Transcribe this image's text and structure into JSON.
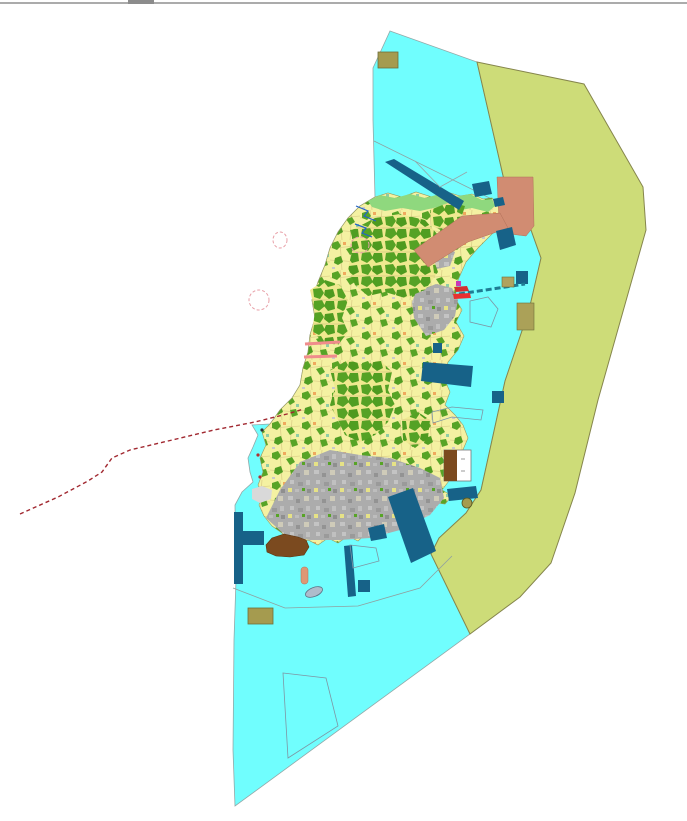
{
  "canvas": {
    "width": 687,
    "height": 821
  },
  "chrome": {
    "top_rule_color": "#ABABAB",
    "top_notch_color": "#8C8C8C",
    "top_notch_x": 128,
    "top_notch_width": 26
  },
  "palette": {
    "water": "#70FEFE",
    "buffer_zone": "#CDDC78",
    "island_parcel_yellow": "#F4F1A2",
    "forest_green": "#55A225",
    "urban_gray": "#ACACAC",
    "navy_structure": "#176288",
    "salmon_district": "#D18C72",
    "brown_port": "#7B4A1F",
    "khaki_block": "#A59B4F",
    "coast_green": "#8FD87E",
    "route_red": "#A12830",
    "boundary_gray": "#8FA0A0"
  },
  "map": {
    "features": [
      {
        "name": "water-body",
        "kind": "polygon",
        "points": "390,31 477,62 504,180 526,216 541,258 529,310 505,381 481,490 466,513 439,538 431,554 470,634 235,806 233,750 234,640 236,580 235,505 242,492 253,482 250,472 248,458 253,447 258,435 252,425 270,424 280,410 292,398 300,385 303,368 308,352 310,335 315,318 312,300 318,282 325,265 330,248 338,232 348,218 360,206 375,197 373,120 373,68",
        "fill": "#70FEFE",
        "stroke": "#93A8A8",
        "sw": 0.8
      },
      {
        "name": "buffer-zone",
        "kind": "polygon",
        "points": "477,62 584,84 643,187 646,230 598,400 575,493 551,563 520,597 470,634 431,554 439,538 466,513 481,490 505,381 529,310 541,258 526,216 504,180",
        "fill": "#CDDC78",
        "stroke": "#85854C",
        "sw": 1
      },
      {
        "name": "boundary-line-north",
        "kind": "line",
        "x1": 374,
        "y1": 141,
        "x2": 526,
        "y2": 216,
        "fill": "none",
        "stroke": "#8FA0A0",
        "sw": 0.8
      },
      {
        "name": "island-base",
        "kind": "polygon",
        "points": "375,197 388,193 402,197 416,192 432,197 447,192 460,196 472,194 483,199 492,198 498,204 502,218 494,232 478,248 466,262 458,280 455,298 462,310 456,322 464,336 458,350 448,362 444,378 450,392 445,405 455,415 463,425 468,438 462,452 448,465 452,477 442,490 452,496 445,504 430,502 420,508 410,504 404,512 407,521 398,530 388,527 380,536 368,532 358,541 348,536 338,543 328,538 318,545 308,540 298,545 288,541 282,533 272,526 264,516 259,505 263,495 258,485 263,472 260,458 266,445 262,432 270,424 280,410 292,398 300,385 303,368 308,352 310,335 315,318 312,300 318,282 325,265 330,248 338,232 348,218 360,206",
        "fill": "pattern:parcel",
        "stroke": "#9A9A5C",
        "sw": 0.6
      },
      {
        "name": "north-coast-green-strip",
        "kind": "polygon",
        "points": "368,201 380,195 395,198 410,194 425,198 440,194 455,197 470,194 482,200 492,199 495,206 488,212 472,208 455,211 438,207 420,211 402,208 385,211 372,207",
        "fill": "#8FD87E",
        "sw": 0
      },
      {
        "name": "urban-area-south",
        "kind": "polygon",
        "points": "266,518 280,490 300,462 330,450 360,455 390,458 420,468 440,478 444,498 430,515 400,530 370,538 340,540 310,540 285,535",
        "fill": "pattern:urban",
        "sw": 0
      },
      {
        "name": "urban-area-east",
        "kind": "polygon",
        "points": "416,292 436,284 452,288 458,300 455,316 444,330 426,336 414,318 412,302",
        "fill": "pattern:urban",
        "sw": 0
      },
      {
        "name": "urban-area-mid",
        "kind": "polygon",
        "points": "420,252 440,246 455,252 450,266 432,270",
        "fill": "pattern:urban",
        "sw": 0
      },
      {
        "name": "forest-cluster-north",
        "kind": "polygon",
        "points": "352,230 375,218 400,214 425,220 438,235 432,255 438,272 425,290 405,298 385,292 368,296 355,285 348,268 352,252",
        "fill": "pattern:dense",
        "sw": 0
      },
      {
        "name": "forest-cluster-west",
        "kind": "polygon",
        "points": "310,290 325,280 340,285 348,300 342,318 348,332 338,345 322,342 312,330 315,312",
        "fill": "pattern:dense",
        "sw": 0
      },
      {
        "name": "forest-cluster-central",
        "kind": "polygon",
        "points": "330,370 348,360 365,365 380,360 392,372 388,390 395,405 388,422 375,435 360,442 345,435 338,420 330,405 335,388",
        "fill": "pattern:dense",
        "sw": 0
      },
      {
        "name": "forest-cluster-southeast",
        "kind": "polygon",
        "points": "402,420 418,412 430,420 428,438 415,448 403,440",
        "fill": "pattern:dense",
        "sw": 0
      },
      {
        "name": "forest-cluster-northeast",
        "kind": "polygon",
        "points": "430,210 450,202 465,206 460,222 445,232 432,226",
        "fill": "pattern:dense",
        "sw": 0
      },
      {
        "name": "salmon-district-block",
        "kind": "polygon",
        "points": "497,177 533,177 534,226 526,236 510,234 499,222",
        "fill": "#D18C72",
        "stroke": "#B07058",
        "sw": 0.5
      },
      {
        "name": "salmon-district-arm",
        "kind": "polygon",
        "points": "414,250 462,216 500,213 508,228 468,242 428,267",
        "fill": "#D18C72",
        "stroke": "#B07058",
        "sw": 0.5
      },
      {
        "name": "river-line-1",
        "kind": "polyline",
        "points": "356,206 368,211 364,216 376,221",
        "fill": "none",
        "stroke": "#2262C8",
        "sw": 1.2
      },
      {
        "name": "river-line-2",
        "kind": "polyline",
        "points": "355,224 366,228 362,233 372,237",
        "fill": "none",
        "stroke": "#2262C8",
        "sw": 1.2
      },
      {
        "name": "navy-breakwater-north",
        "kind": "polygon",
        "points": "385,162 394,159 464,201 459,210",
        "fill": "#176288",
        "sw": 0
      },
      {
        "name": "navy-block-ne-1",
        "kind": "polygon",
        "points": "472,184 489,181 492,194 475,197",
        "fill": "#176288",
        "sw": 0
      },
      {
        "name": "navy-block-ne-2",
        "kind": "polygon",
        "points": "493,199 503,197 505,205 495,207",
        "fill": "#176288",
        "sw": 0
      },
      {
        "name": "navy-block-ne-3",
        "kind": "polygon",
        "points": "496,231 512,227 516,245 500,250",
        "fill": "#176288",
        "sw": 0
      },
      {
        "name": "navy-rect-east",
        "kind": "rect",
        "x": 516,
        "y": 271,
        "width": 12,
        "height": 13,
        "fill": "#176288",
        "sw": 0
      },
      {
        "name": "navy-band-east",
        "kind": "polygon",
        "points": "423,362 473,366 471,387 421,381",
        "fill": "#176288",
        "sw": 0
      },
      {
        "name": "navy-rect-mid",
        "kind": "rect",
        "x": 433,
        "y": 343,
        "width": 9,
        "height": 10,
        "fill": "#176288",
        "sw": 0
      },
      {
        "name": "navy-rect-se",
        "kind": "rect",
        "x": 492,
        "y": 391,
        "width": 12,
        "height": 12,
        "fill": "#176288",
        "sw": 0
      },
      {
        "name": "navy-band-bay-ne",
        "kind": "polygon",
        "points": "447,489 476,486 478,498 449,501",
        "fill": "#176288",
        "sw": 0
      },
      {
        "name": "navy-band-southeast",
        "kind": "polygon",
        "points": "388,497 413,488 436,551 411,563",
        "fill": "#176288",
        "sw": 0
      },
      {
        "name": "navy-pier-south",
        "kind": "polygon",
        "points": "344,546 352,545 356,596 348,597",
        "fill": "#176288",
        "sw": 0
      },
      {
        "name": "navy-square-south",
        "kind": "rect",
        "x": 358,
        "y": 580,
        "width": 12,
        "height": 12,
        "fill": "#176288",
        "sw": 0
      },
      {
        "name": "navy-jetty-west-vertical",
        "kind": "rect",
        "x": 234,
        "y": 512,
        "width": 9,
        "height": 72,
        "fill": "#176288",
        "sw": 0
      },
      {
        "name": "navy-jetty-west-arm",
        "kind": "rect",
        "x": 243,
        "y": 531,
        "width": 21,
        "height": 14,
        "fill": "#176288",
        "sw": 0
      },
      {
        "name": "navy-chunk-coast",
        "kind": "polygon",
        "points": "368,528 384,524 387,538 371,541",
        "fill": "#176288",
        "sw": 0
      },
      {
        "name": "teal-dashed-cable",
        "kind": "line",
        "x1": 459,
        "y1": 294,
        "x2": 525,
        "y2": 284,
        "fill": "none",
        "stroke": "#1E7C94",
        "sw": 3,
        "dash": "6 3"
      },
      {
        "name": "khaki-block-top",
        "kind": "rect",
        "x": 378,
        "y": 52,
        "width": 20,
        "height": 16,
        "fill": "#A59B4F",
        "stroke": "#6E6E3A",
        "sw": 0.8
      },
      {
        "name": "khaki-block-east-small",
        "kind": "rect",
        "x": 502,
        "y": 277,
        "width": 12,
        "height": 10,
        "fill": "#B0A25E",
        "stroke": "#6E6E3A",
        "sw": 0.6
      },
      {
        "name": "khaki-block-east-large",
        "kind": "rect",
        "x": 517,
        "y": 303,
        "width": 17,
        "height": 27,
        "fill": "#ABA158",
        "stroke": "#6E6E3A",
        "sw": 0.6
      },
      {
        "name": "khaki-block-southwest",
        "kind": "rect",
        "x": 248,
        "y": 608,
        "width": 25,
        "height": 16,
        "fill": "#A59B4F",
        "stroke": "#6E6E3A",
        "sw": 0.8
      },
      {
        "name": "khaki-islet",
        "kind": "ellipse",
        "cx": 467,
        "cy": 503,
        "rx": 5,
        "ry": 5,
        "fill": "#A59B4F",
        "stroke": "#55551F",
        "sw": 0.8
      },
      {
        "name": "brown-port-blob",
        "kind": "polygon",
        "points": "266,545 272,538 284,534 298,537 306,540 309,547 304,555 290,557 276,556 267,552",
        "fill": "#7B4A1F",
        "stroke": "#5A340F",
        "sw": 0.6
      },
      {
        "name": "split-block-outline",
        "kind": "rect",
        "x": 444,
        "y": 450,
        "width": 27,
        "height": 31,
        "fill": "#FFFFFF",
        "stroke": "#777777",
        "sw": 0.8
      },
      {
        "name": "split-block-brown-half",
        "kind": "rect",
        "x": 444,
        "y": 450,
        "width": 13,
        "height": 31,
        "fill": "#7B4A1F",
        "sw": 0
      },
      {
        "name": "split-block-tick-1",
        "kind": "line",
        "x1": 461,
        "y1": 459,
        "x2": 465,
        "y2": 459,
        "fill": "none",
        "stroke": "#999999",
        "sw": 1
      },
      {
        "name": "split-block-tick-2",
        "kind": "line",
        "x1": 461,
        "y1": 471,
        "x2": 465,
        "y2": 471,
        "fill": "none",
        "stroke": "#999999",
        "sw": 1
      },
      {
        "name": "outlined-parcel-pentagon",
        "kind": "polygon",
        "points": "470,301 488,297 498,309 491,327 470,322",
        "fill": "none",
        "stroke": "#7E96A4",
        "sw": 0.8
      },
      {
        "name": "outlined-parcel-long",
        "kind": "polygon",
        "points": "432,412 452,407 483,410 481,420 452,417 433,423",
        "fill": "none",
        "stroke": "#7E96A4",
        "sw": 0.8
      },
      {
        "name": "outlined-parcel-quad",
        "kind": "polygon",
        "points": "350,545 376,548 379,561 353,568",
        "fill": "none",
        "stroke": "#7E96A4",
        "sw": 0.8
      },
      {
        "name": "outlined-parcel-bottom",
        "kind": "polygon",
        "points": "283,673 326,678 338,726 288,758",
        "fill": "none",
        "stroke": "#7E96A4",
        "sw": 0.8
      },
      {
        "name": "boundary-line-south",
        "kind": "polyline",
        "points": "233,588 285,608 358,606 420,588 452,556",
        "fill": "none",
        "stroke": "#8FA0A0",
        "sw": 0.8
      },
      {
        "name": "gray-flats-patch",
        "kind": "polygon",
        "points": "252,489 262,486 272,490 271,499 260,503 252,499",
        "fill": "#D9D9D9",
        "sw": 0
      },
      {
        "name": "salmon-buoy-bar",
        "kind": "rect",
        "x": 301,
        "y": 567,
        "width": 7,
        "height": 17,
        "rx": 3,
        "fill": "#DE9874",
        "stroke": "#B07058",
        "sw": 0.5
      },
      {
        "name": "boat-islet",
        "kind": "ellipse",
        "cx": 314,
        "cy": 592,
        "rx": 9,
        "ry": 4.5,
        "fill": "#AEBCCB",
        "stroke": "#5F7286",
        "sw": 0.8,
        "transform": "rotate(-22 314 592)"
      },
      {
        "name": "magenta-marker",
        "kind": "rect",
        "x": 456,
        "y": 281,
        "width": 5,
        "height": 5,
        "fill": "#C838B8",
        "sw": 0
      },
      {
        "name": "red-patch-east",
        "kind": "polygon",
        "points": "454,287 467,286 469,291 456,292",
        "fill": "#D23030",
        "sw": 0
      },
      {
        "name": "red-arrow-east",
        "kind": "polygon",
        "points": "453,294 470,293 471,298 454,299",
        "fill": "#E83030",
        "sw": 0
      },
      {
        "name": "gray-v-lines",
        "kind": "polyline",
        "points": "415,161 440,187 467,172",
        "fill": "none",
        "stroke": "#98A4A8",
        "sw": 0.8
      },
      {
        "name": "pink-groyne-1",
        "kind": "line",
        "x1": 305,
        "y1": 344,
        "x2": 340,
        "y2": 342,
        "fill": "none",
        "stroke": "#F08C8C",
        "sw": 3
      },
      {
        "name": "pink-groyne-2",
        "kind": "line",
        "x1": 304,
        "y1": 357,
        "x2": 337,
        "y2": 356,
        "fill": "none",
        "stroke": "#F08C8C",
        "sw": 3
      },
      {
        "name": "dashed-ellipse-west",
        "kind": "ellipse",
        "cx": 259,
        "cy": 300,
        "rx": 10,
        "ry": 10,
        "fill": "none",
        "stroke": "#E8A0A8",
        "sw": 1,
        "dash": "3 2"
      },
      {
        "name": "dashed-ellipse-nw",
        "kind": "ellipse",
        "cx": 280,
        "cy": 240,
        "rx": 7,
        "ry": 8,
        "fill": "none",
        "stroke": "#E8A0A8",
        "sw": 1,
        "dash": "3 2"
      },
      {
        "name": "dashed-ellipse-north",
        "kind": "ellipse",
        "cx": 360,
        "cy": 245,
        "rx": 9,
        "ry": 8,
        "fill": "none",
        "stroke": "#E8A0A8",
        "sw": 1,
        "dash": "3 2"
      },
      {
        "name": "coast-dot-1",
        "kind": "ellipse",
        "cx": 260,
        "cy": 477,
        "rx": 1.6,
        "ry": 1.6,
        "fill": "#B03030",
        "sw": 0
      },
      {
        "name": "coast-dot-2",
        "kind": "ellipse",
        "cx": 262,
        "cy": 430,
        "rx": 1.6,
        "ry": 1.6,
        "fill": "#303030",
        "sw": 0
      },
      {
        "name": "coast-dot-3",
        "kind": "ellipse",
        "cx": 258,
        "cy": 455,
        "rx": 1.6,
        "ry": 1.6,
        "fill": "#B03030",
        "sw": 0
      },
      {
        "name": "red-dashed-route",
        "kind": "polyline",
        "points": "20,514 58,497 88,481 102,472 112,458 130,450 168,441 214,430 255,422 287,414 304,409",
        "fill": "none",
        "stroke": "#A12830",
        "sw": 1.4,
        "dash": "4 3"
      }
    ]
  }
}
